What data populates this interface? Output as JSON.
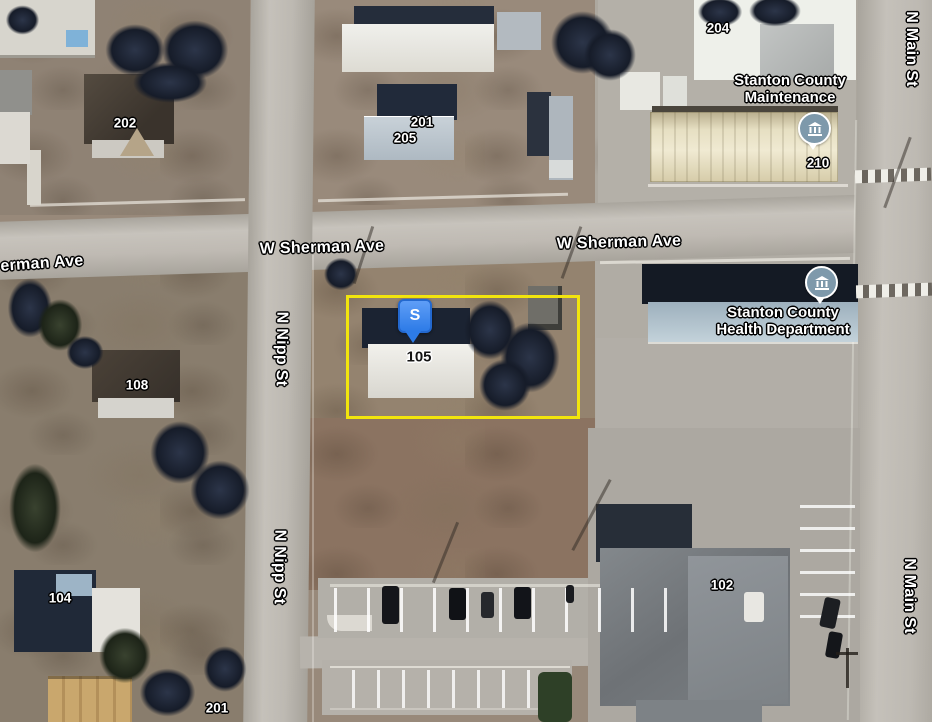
{
  "map_labels": {
    "streets": {
      "sherman_partial": "erman Ave",
      "sherman_center": "W Sherman Ave",
      "sherman_east": "W Sherman Ave",
      "nipp_north": "N Nipp St",
      "nipp_south": "N Nipp St",
      "main_north": "N Main St",
      "main_south": "N Main St"
    },
    "pois": {
      "maintenance": {
        "line1": "Stanton County",
        "line2": "Maintenance",
        "icon": "government-building"
      },
      "health": {
        "line1": "Stanton County",
        "line2": "Health Department",
        "icon": "government-building"
      }
    },
    "addresses": {
      "n202": "202",
      "n201_top": "201",
      "n205": "205",
      "n204": "204",
      "n210": "210",
      "n108": "108",
      "n104": "104",
      "n102": "102",
      "n201_bottom": "201",
      "n105": "105"
    },
    "marker": {
      "letter": "S"
    },
    "colors": {
      "parcel_outline": "#f2e50d",
      "marker_blue": "#3c86f0",
      "poi_icon_fill": "#7e99ab",
      "road": "#bcb8b1",
      "dirt": "#8f8070"
    }
  }
}
